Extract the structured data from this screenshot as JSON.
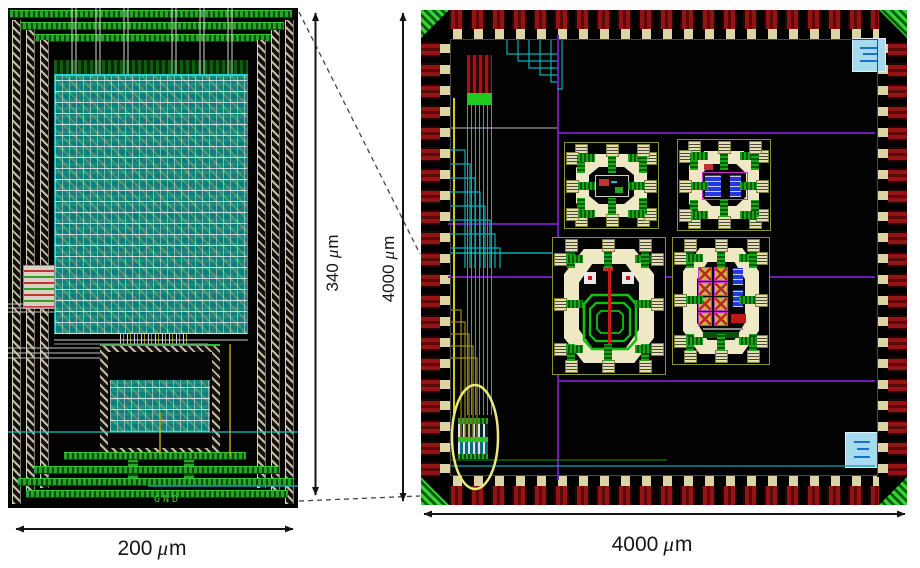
{
  "figure": {
    "dimension_labels": {
      "left_width": {
        "value": "200",
        "mu": "μ",
        "unit": "m"
      },
      "left_height": {
        "value": "340",
        "mu": "μ",
        "unit": "m"
      },
      "right_width": {
        "value": "4000",
        "mu": "μ",
        "unit": "m"
      },
      "right_height": {
        "value": "4000",
        "mu": "μ",
        "unit": "m"
      }
    },
    "left_chip": {
      "gnd_label": "GND"
    },
    "colors": {
      "page_bg": "#ffffff",
      "chip_bg": "#020202",
      "rail_green": "#27a327",
      "guard_hatch_tan": "#c3bba8",
      "cell_teal": "#0d7d7d",
      "pad_dark_red": "#921414",
      "pad_beige": "#dcd4a2",
      "corner_green": "#33d433",
      "boundary_purple": "#6a1bb8",
      "frame_cream": "#efe8c4",
      "inductor_green": "#10c010",
      "device_blue": "#2439dd",
      "highlight_ellipse_yellow": "#e9e97e",
      "esd_cyan": "#a5dbed",
      "annotation_black": "#141414"
    }
  }
}
